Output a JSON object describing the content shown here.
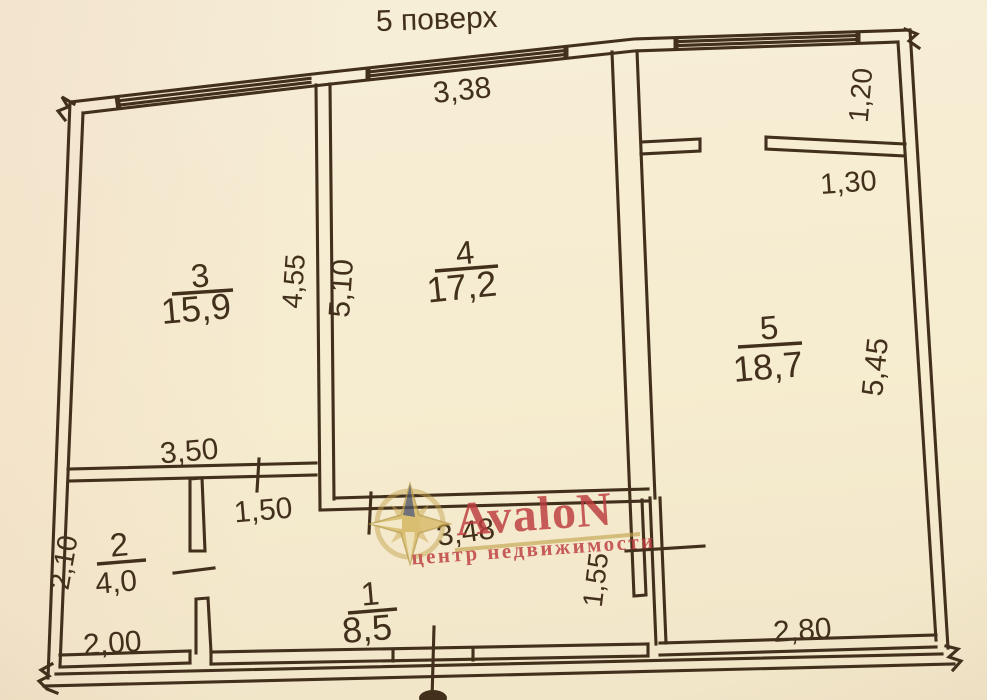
{
  "title": "5 поверх",
  "watermark": {
    "brand": "AvaloN",
    "tagline": "центр недвижимости"
  },
  "rooms": {
    "r1": {
      "number": "1",
      "area": "8,5"
    },
    "r2": {
      "number": "2",
      "area": "4,0"
    },
    "r3": {
      "number": "3",
      "area": "15,9"
    },
    "r4": {
      "number": "4",
      "area": "17,2"
    },
    "r5": {
      "number": "5",
      "area": "18,7"
    }
  },
  "dims": {
    "room4_top_width": "3,38",
    "room3_right_height": "4,55",
    "room4_left_height": "5,10",
    "balcony_depth": "1,20",
    "room5_top_offset": "1,30",
    "room5_right_height": "5,45",
    "room5_bottom_width": "2,80",
    "room3_bottom_width": "3,50",
    "hall_top_left_width": "1,50",
    "hall_width": "3,48",
    "hall_right_height": "1,55",
    "room2_left_height": "2,10",
    "room2_bottom_width": "2,00"
  },
  "colors": {
    "ink": "#42301d",
    "paper": "#f5ecd2",
    "brand_red": "#bc3b3e",
    "brand_gold": "#c5a551"
  }
}
